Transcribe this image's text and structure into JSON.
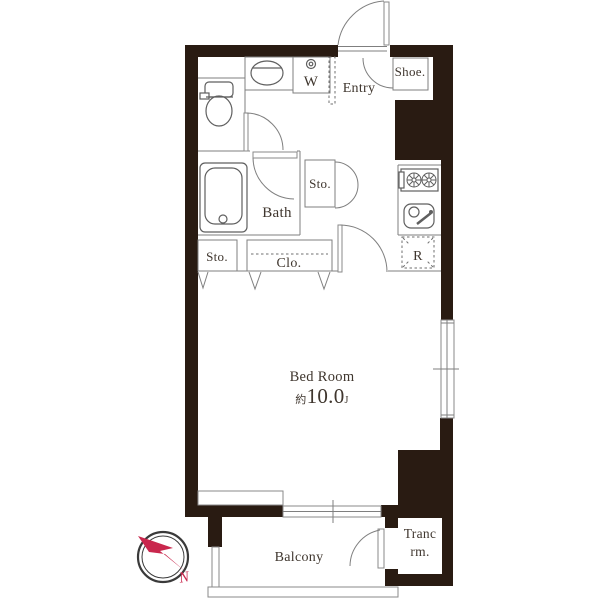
{
  "title": "Apartment floor plan",
  "colors": {
    "wall": "#291b12",
    "line": "#7f7f7f",
    "text": "#3f362e",
    "accent_red": "#c9274d"
  },
  "rooms": {
    "entry": {
      "label": "Entry"
    },
    "shoe": {
      "label": "Shoe."
    },
    "washer": {
      "label": "W"
    },
    "bath": {
      "label": "Bath"
    },
    "storage_upper": {
      "label": "Sto."
    },
    "storage_lower": {
      "label": "Sto."
    },
    "closet": {
      "label": "Clo."
    },
    "refrigerator": {
      "label": "R"
    },
    "bedroom": {
      "label": "Bed Room",
      "size_prefix": "約",
      "size_value": "10.0",
      "size_unit": "J"
    },
    "balcony": {
      "label": "Balcony"
    },
    "trunk": {
      "label_line1": "Tranc",
      "label_line2": "rm."
    }
  },
  "compass": {
    "north_label": "N"
  }
}
